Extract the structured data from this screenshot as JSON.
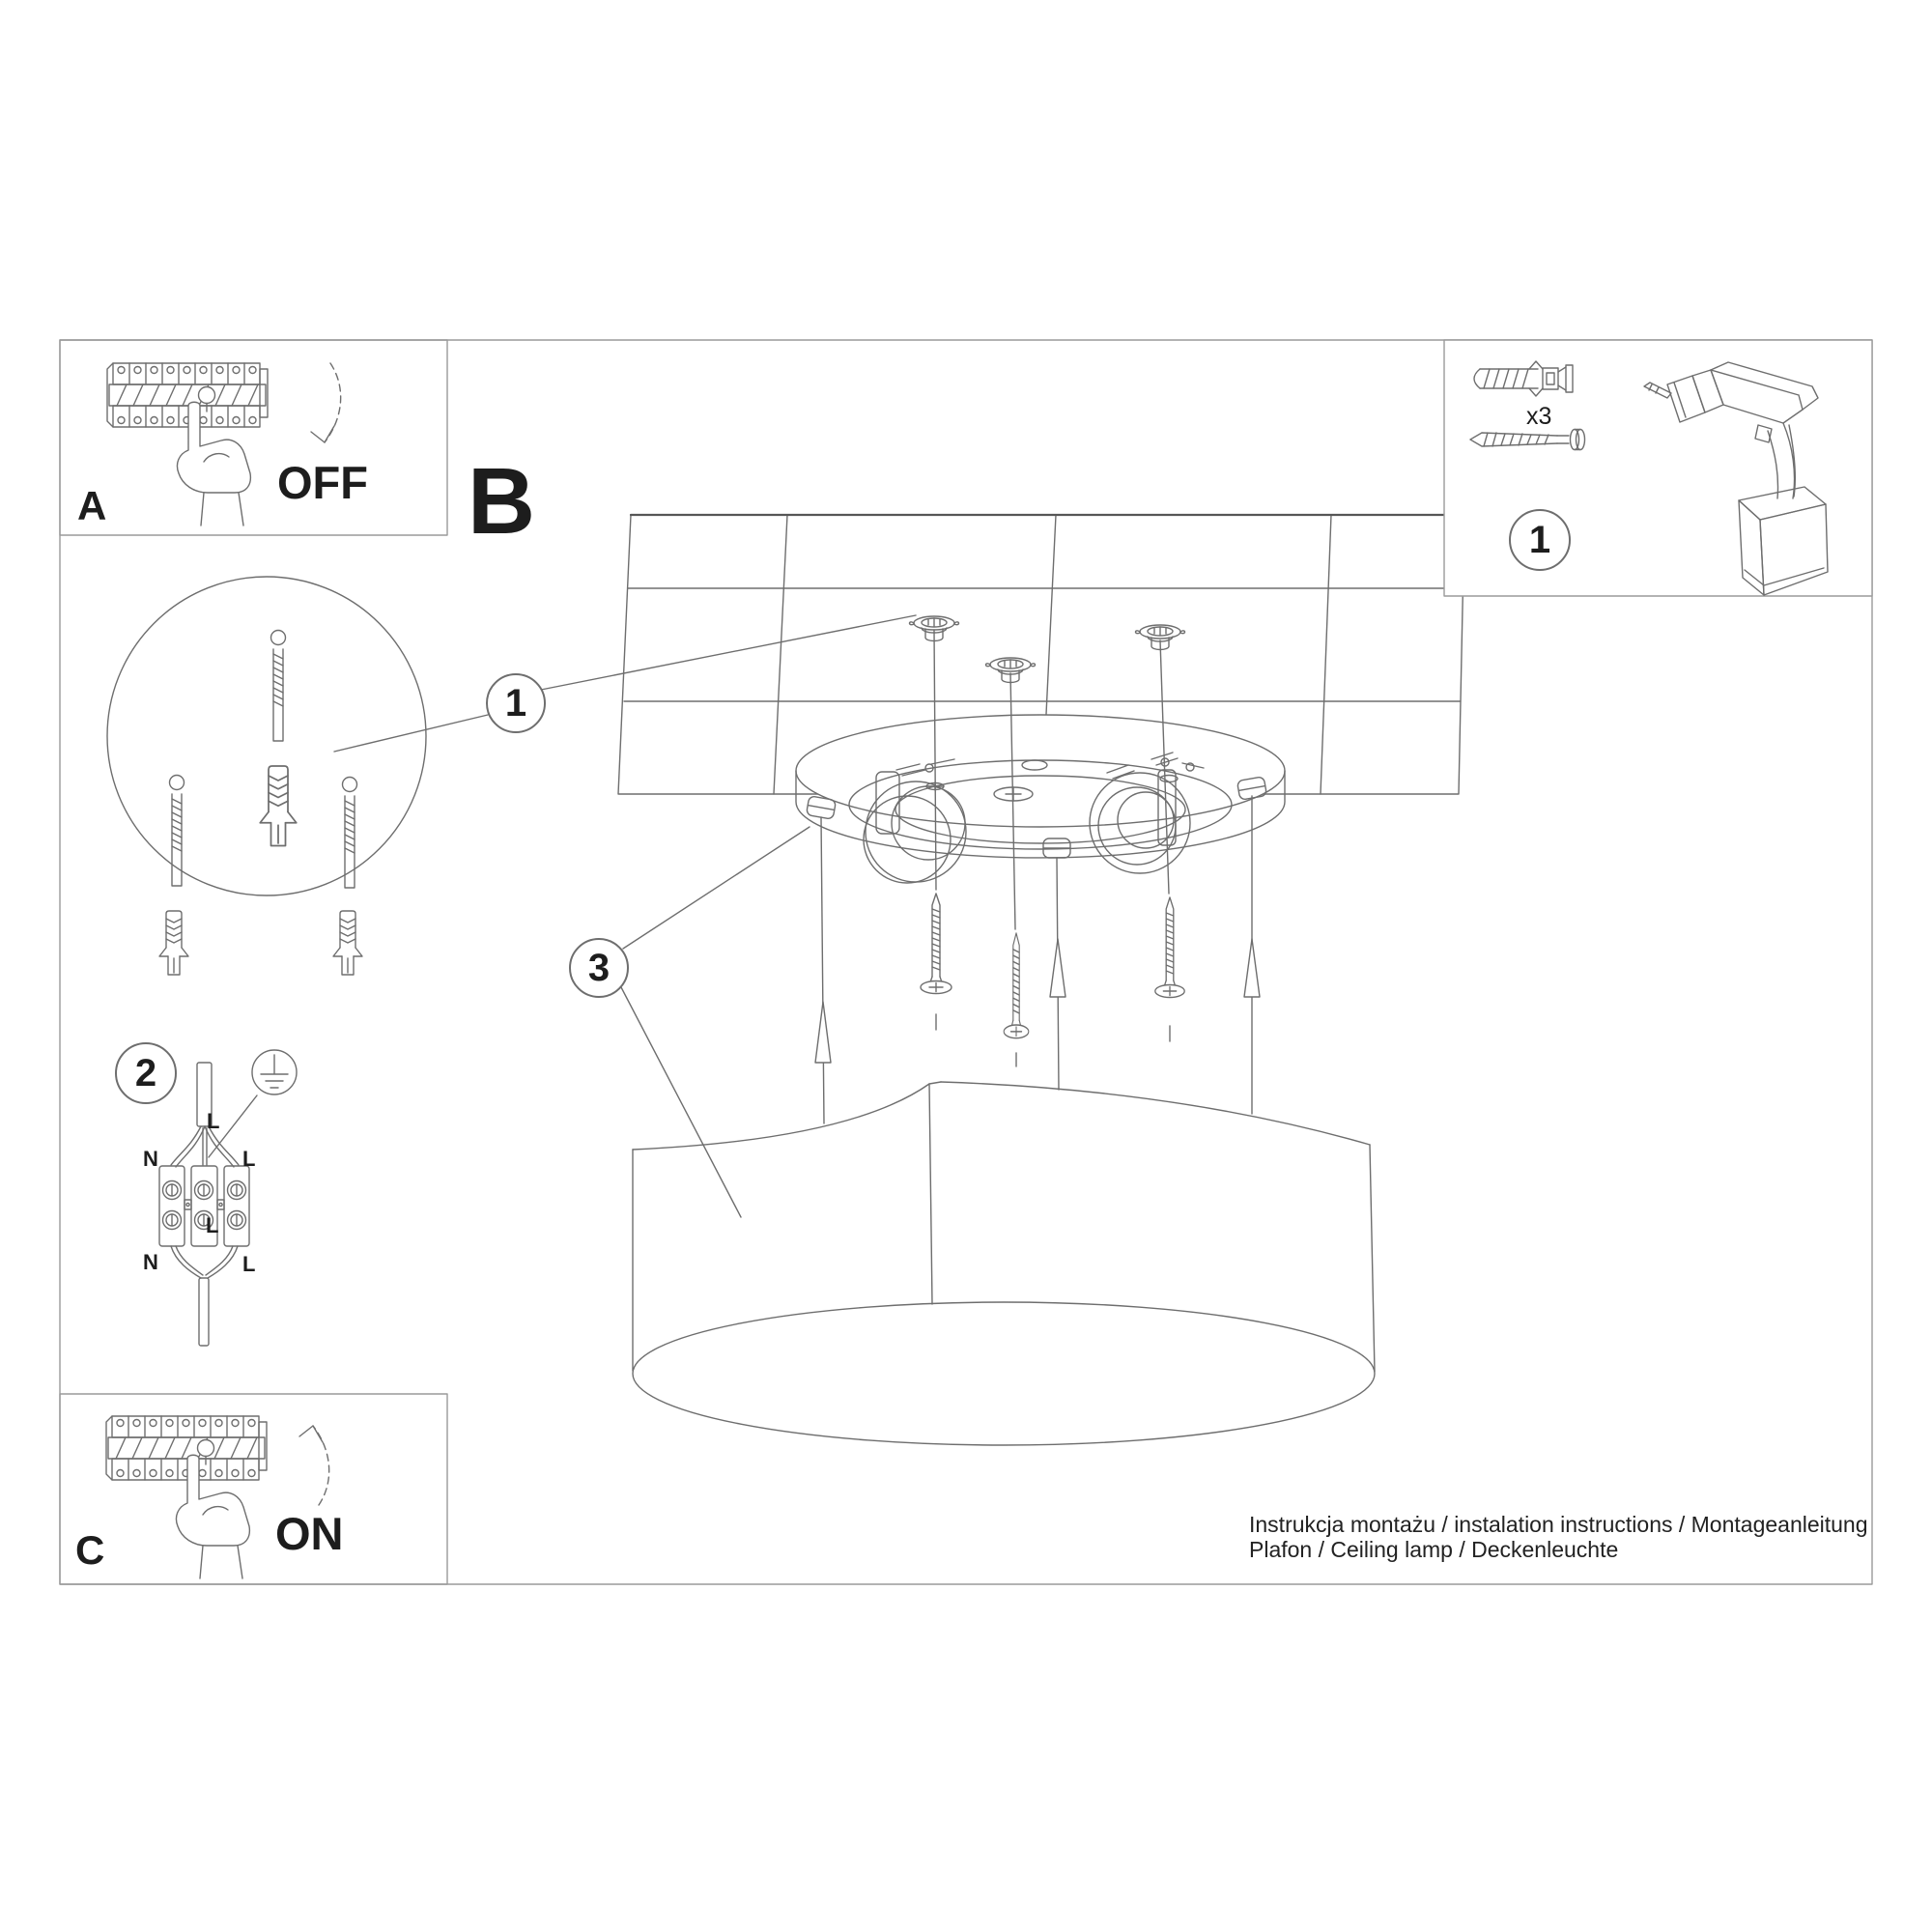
{
  "colors": {
    "background": "#ffffff",
    "line": "#6e6e6e",
    "line_dark": "#565656",
    "text": "#1d1d1d"
  },
  "panel_a": {
    "label": "A",
    "action": "OFF"
  },
  "panel_b": {
    "label": "B"
  },
  "panel_c": {
    "label": "C",
    "action": "ON"
  },
  "kit": {
    "callout": "1",
    "quantity_label": "x3"
  },
  "callouts": {
    "anchors_detail": "1",
    "wiring": "2",
    "canopy": "3"
  },
  "wiring_labels": {
    "incoming_line": "L",
    "neutral_top": "N",
    "line_top": "L",
    "line_mid": "L",
    "neutral_bottom": "N",
    "line_bottom": "L"
  },
  "footer": {
    "line1": "Instrukcja montażu / instalation instructions / Montageanleitung",
    "line2": "Plafon / Ceiling lamp / Deckenleuchte"
  },
  "icons": {
    "kit_panel": [
      "wall-plug-icon",
      "screw-icon",
      "drill-icon"
    ],
    "panel_a": [
      "breaker-strip-icon",
      "hand-press-icon",
      "arrow-down-icon"
    ],
    "panel_c": [
      "breaker-strip-icon",
      "hand-press-icon",
      "arrow-up-icon"
    ],
    "wiring": [
      "ground-icon",
      "terminal-block-icon"
    ],
    "main_view": [
      "ceiling-icon",
      "mounting-plate-icon",
      "screw-icon",
      "lamp-shade-icon",
      "wall-plug-icon"
    ]
  }
}
